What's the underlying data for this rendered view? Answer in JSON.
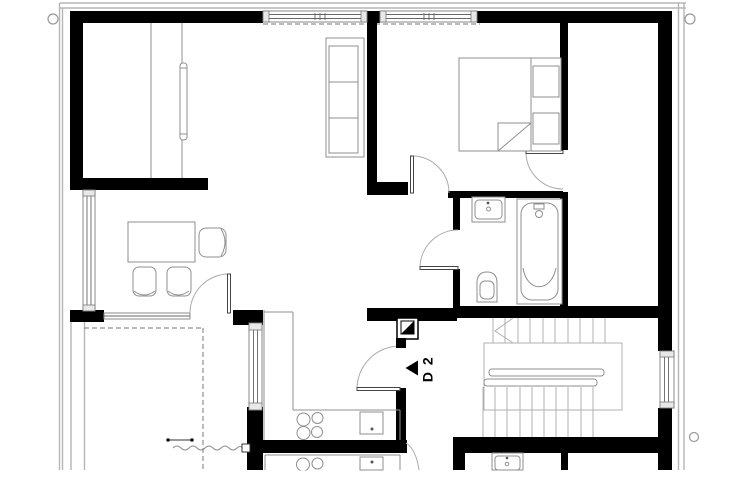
{
  "plan": {
    "kind": "apartment-floor-plan",
    "door_label": "D 2"
  },
  "colors": {
    "wall": "#000000",
    "furniture_line": "#8f8f8f",
    "frame_line": "#b5b5b5",
    "dashed_line": "#7a7a7a",
    "background": "#ffffff"
  },
  "fixtures": {
    "bedroom": "double bed with two pillows",
    "bathroom": "washbasin, bathtub, toilet",
    "kitchen": "L-shaped counter with 4-burner cooktop and appliance",
    "dining": "table with three chairs",
    "living": "three-section cabinet, wardrobe with radiator",
    "circulation": "U-shaped staircase with handrails",
    "service": "chimney shaft symbol at entrance door"
  },
  "markers": {
    "survey_circle_count": "3"
  }
}
